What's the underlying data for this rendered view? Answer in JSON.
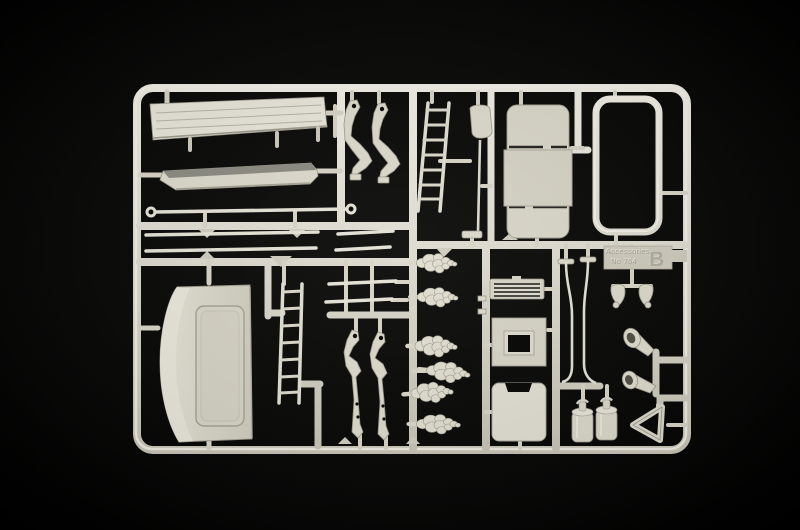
{
  "scene": {
    "type": "photograph",
    "subject": "Injection-molded plastic model kit sprue (parts tree) in light grey styrene, photographed on a black background",
    "background_color": "#000000",
    "plastic_color": "#dedbce",
    "plastic_highlight": "#f2f0e7",
    "plastic_shadow": "#9d9a8d"
  },
  "sprue": {
    "molded_label": {
      "line1": "Accessories",
      "line2": "No 764",
      "letter": "B"
    },
    "parts": [
      "wind deflector panel",
      "sun visor",
      "grab rail with eyelet ends",
      "long trim rods",
      "short trim rods",
      "cab roof panel with sunroof recess",
      "short access ladder",
      "long access ladder",
      "grab bars",
      "mirror arms",
      "wiper arms",
      "sign board on pole",
      "bunk bed panel",
      "tubular bed frame",
      "roof grille vent",
      "roof hatch box",
      "mud flap panel",
      "ornament figures",
      "bent stay rods",
      "twin air horns",
      "trumpet horns",
      "milk churn cans",
      "warning triangle"
    ]
  }
}
